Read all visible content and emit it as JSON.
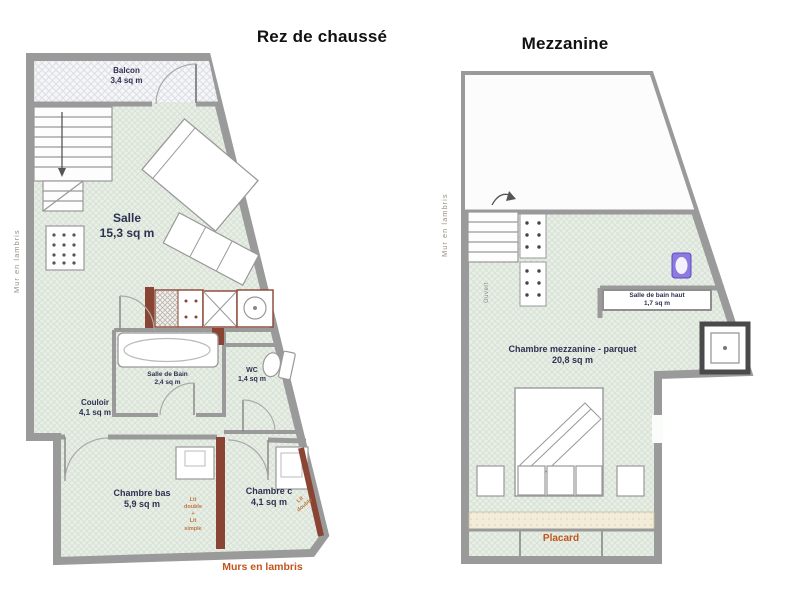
{
  "titles": {
    "ground": "Rez de chaussé",
    "mezzanine": "Mezzanine"
  },
  "plans": {
    "ground": {
      "rooms": {
        "balcon": {
          "name": "Balcon",
          "area": "3,4 sq m"
        },
        "salle": {
          "name": "Salle",
          "area": "15,3 sq m"
        },
        "salle_de_bain": {
          "name": "Salle de Bain",
          "area": "2,4 sq m"
        },
        "wc": {
          "name": "WC",
          "area": "1,4 sq m"
        },
        "couloir": {
          "name": "Couloir",
          "area": "4,1 sq m"
        },
        "chambre_bas": {
          "name": "Chambre bas",
          "area": "5,9 sq m"
        },
        "chambre_c": {
          "name": "Chambre c",
          "area": "4,1 sq m"
        }
      },
      "annotations": {
        "mur_gauche": "Mur en lambris",
        "murs_bas": "Murs en lambris",
        "lit_double_simple": "Lit\ndouble\n+\nLit\nsimple",
        "lit_double": "Lit\ndouble"
      }
    },
    "mezzanine": {
      "rooms": {
        "chambre": {
          "name": "Chambre mezzanine - parquet",
          "area": "20,8 sq m"
        },
        "sdb_haut": {
          "name": "Salle de bain haut",
          "area": "1,7 sq m"
        },
        "placard": {
          "name": "Placard"
        }
      },
      "annotations": {
        "mur_gauche": "Mur en lambris",
        "ouvert": "Ouvert"
      }
    }
  },
  "colors": {
    "wall_gray": "#9a9a9a",
    "floor_green": "#e9efe7",
    "label_navy": "#2e3152",
    "accent_orange": "#c2551e",
    "wood_wall_brown": "#8a4433",
    "sink_purple": "#8d7ae0"
  }
}
